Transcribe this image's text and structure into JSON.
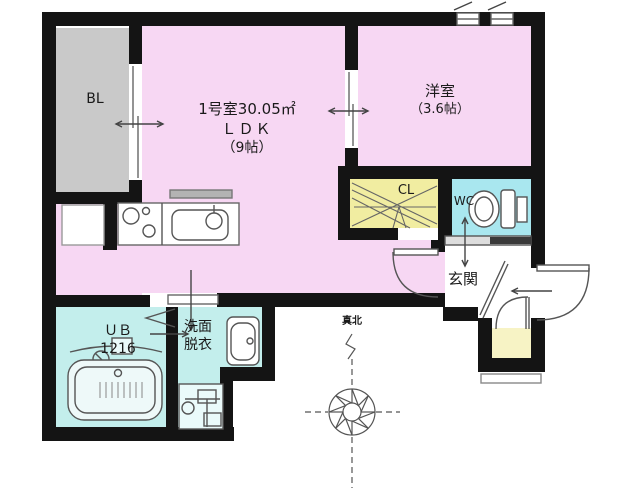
{
  "floorplan": {
    "balcony": {
      "label": "BL"
    },
    "ldk": {
      "room_number": "1号室30.05㎡",
      "type": "ＬＤＫ",
      "size": "（9帖）"
    },
    "western_room": {
      "name": "洋室",
      "size": "（3.6帖）"
    },
    "closet": {
      "label": "CL"
    },
    "toilet": {
      "label": "WC"
    },
    "entrance": {
      "label": "玄関"
    },
    "unit_bath": {
      "label": "ＵＢ",
      "size": "1216"
    },
    "washroom": {
      "line1": "洗面",
      "line2": "脱衣"
    },
    "compass": {
      "label": "真北"
    },
    "colors": {
      "wall": "#141414",
      "room_pink": "#f7d7f3",
      "balcony_gray": "#c9c9c9",
      "closet_yellow": "#f1eda1",
      "toilet_cyan": "#a9e7ef",
      "bath_cyan": "#c3eeec",
      "storage_yellow": "#f7f3c5",
      "fixture_line": "#555555"
    }
  }
}
